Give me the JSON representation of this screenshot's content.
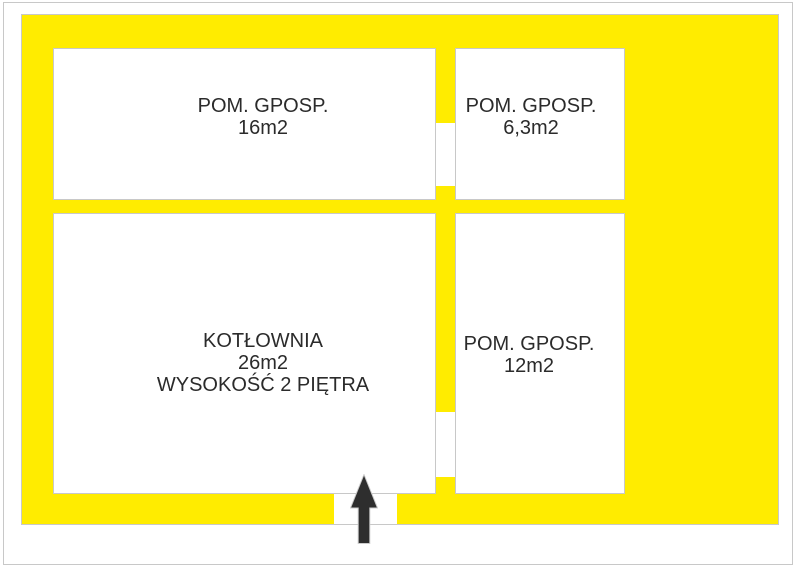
{
  "colors": {
    "background": "#ffffff",
    "wall_yellow": "#ffec00",
    "outline_gray": "#c8c8c8",
    "text_dark": "#2b2b2b",
    "arrow_dark": "#2e2e2e"
  },
  "floorplan": {
    "rooms": [
      {
        "name": "POM. GPOSP.",
        "area": "16m2"
      },
      {
        "name": "POM. GPOSP.",
        "area": "6,3m2"
      },
      {
        "name": "KOTŁOWNIA",
        "area": "26m2",
        "note": "WYSOKOŚĆ 2 PIĘTRA"
      },
      {
        "name": "POM. GPOSP.",
        "area": "12m2"
      }
    ],
    "icons": {
      "entrance_arrow": "up-arrow"
    }
  }
}
